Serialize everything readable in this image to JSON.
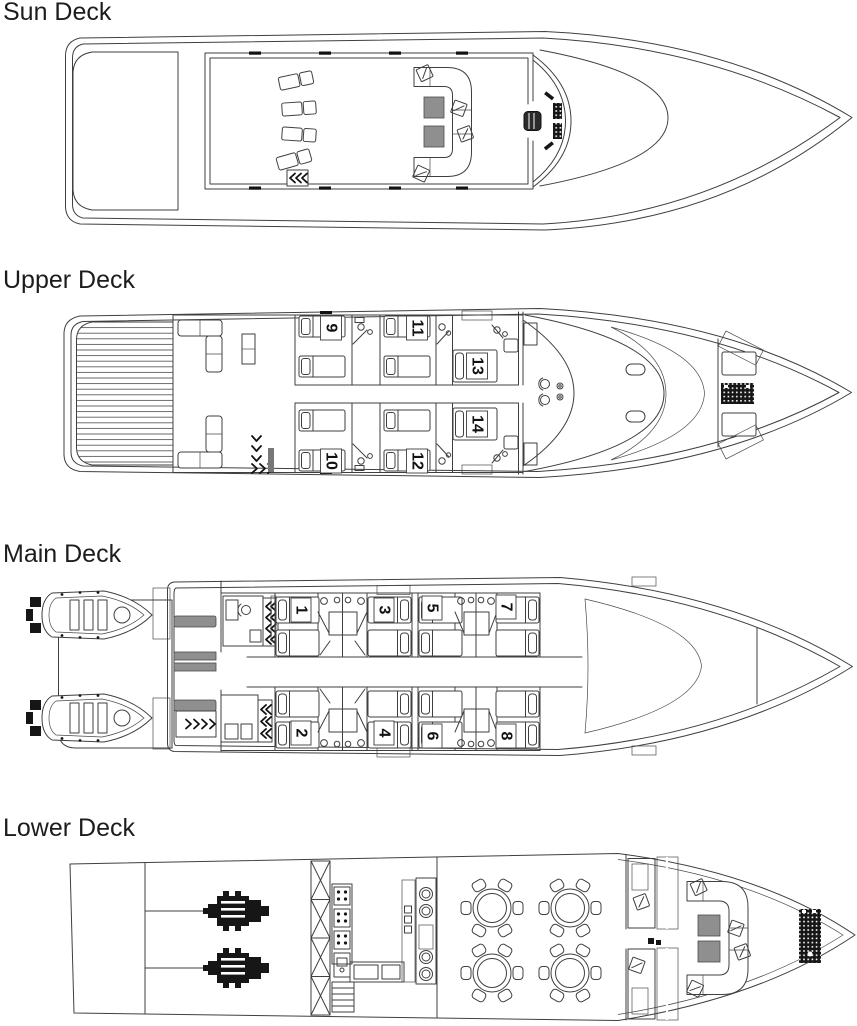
{
  "page": {
    "background": "#ffffff",
    "line_color": "#3f3f3f",
    "table_fill": "#8f8f8f",
    "equipment_fill": "#161616",
    "label_color": "#1c1c1c"
  },
  "decks": {
    "sun": {
      "label": "Sun Deck",
      "elements": [
        "teak aft deck",
        "4 sun loungers",
        "stairs",
        "U-shaped sofa",
        "2 coffee tables",
        "4 armchair cushions",
        "helm seat",
        "helm console",
        "curved windscreen"
      ]
    },
    "upper": {
      "label": "Upper Deck",
      "cabins": [
        "9",
        "11",
        "13",
        "10",
        "12",
        "14"
      ],
      "elements": [
        "teak aft deck",
        "2 corner sofas",
        "bar counter",
        "stairs",
        "6 guest cabins with bathrooms",
        "wheelhouse with 2 helm chairs",
        "teak foredeck",
        "2 deck hatches",
        "2 sun pads",
        "bow table",
        "boarding ladders"
      ]
    },
    "main": {
      "label": "Main Deck",
      "cabins": [
        "1",
        "3",
        "5",
        "7",
        "2",
        "4",
        "6",
        "8"
      ],
      "elements": [
        "2 tenders with outboard engines",
        "swim platform",
        "davit blocks",
        "3 benches",
        "office desk",
        "stairs",
        "8 guest cabins with shared bathrooms",
        "teak foredeck"
      ]
    },
    "lower": {
      "label": "Lower Deck",
      "elements": [
        "engine room with 2 engines and prop shafts",
        "watertight cross-braced bulkhead",
        "galley with cooker, counters and stairs",
        "4 round dining tables with 6 chairs each",
        "2 crew cabins",
        "hatched companionway walls",
        "U-shaped bow lounge",
        "2 coffee tables",
        "anchor windlass"
      ]
    }
  }
}
